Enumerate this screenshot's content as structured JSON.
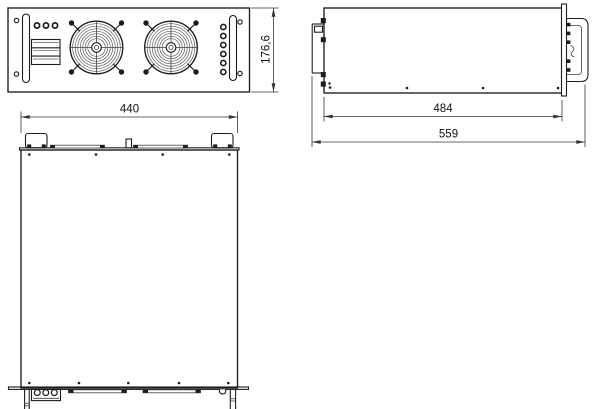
{
  "drawing": {
    "type": "technical-dimension-drawing",
    "unit_style": "millimeters-implied",
    "colors": {
      "line": "#1c1c1c",
      "dimension_line": "#343434",
      "background": "#ffffff"
    }
  },
  "dimensions": {
    "front_width": "440",
    "front_height": "176,6",
    "side_body_depth": "484",
    "side_total_depth": "559"
  },
  "components": {
    "front_view": [
      "rack-mount-hole",
      "handle-bar",
      "status-led-row",
      "vent-louver-block",
      "fan-grille-left",
      "fan-grille-right",
      "indicator-hole-column"
    ],
    "side_view": [
      "chassis-body",
      "front-panel-edge",
      "carry-handle",
      "rear-connector-tabs",
      "bottom-screws"
    ],
    "top_view": [
      "chassis-body",
      "front-panel-edge",
      "handle-left",
      "handle-right",
      "center-tab",
      "front-strips",
      "rear-panel-edge",
      "terminal-block",
      "rear-strips",
      "rear-notch",
      "mount-leg-left",
      "mount-leg-right",
      "cover-screws"
    ]
  }
}
